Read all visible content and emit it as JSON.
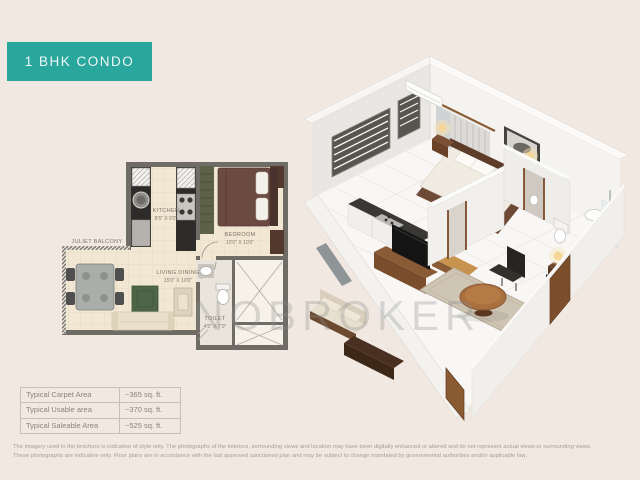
{
  "header": {
    "badge": "1 BHK CONDO"
  },
  "watermark": "NOBROKER",
  "floorplan": {
    "kitchen_name": "KITCHEN",
    "kitchen_dims": "8'6\" X 9'2\"",
    "bedroom_name": "BEDROOM",
    "bedroom_dims": "10'0\" X 10'0\"",
    "living_name": "LIVING DINING",
    "living_dims": "15'0\" X 10'0\"",
    "balcony_name": "JULIET BALCONY",
    "toilet_name": "TOILET",
    "toilet_dims": "4'5\" X 7'0\""
  },
  "area_table": {
    "rows": [
      {
        "label": "Typical Carpet Area",
        "value": "~365 sq. ft."
      },
      {
        "label": "Typical Usable area",
        "value": "~370 sq. ft."
      },
      {
        "label": "Typical Saleable Area",
        "value": "~525 sq. ft."
      }
    ]
  },
  "disclaimer": {
    "line1": "The imagery used in the brochure is indicative of style only. The photographs of the interiors, surrounding views and location may have been digitally enhanced or altered and do not represent actual views or surrounding views.",
    "line2": "These photographs are indicative only. Floor plans are in accordance with the last approved sanctioned plan and may be subject to change mandated by governmental authorities and/or applicable law."
  },
  "colors": {
    "background": "#f1e8e1",
    "badge_teal": "#2aa79d",
    "plan_floor": "#f1e7d3",
    "plan_wall": "#6f6c66",
    "counter_dark": "#2e2c2a",
    "bed_brown": "#6b4a41",
    "rug_green": "#4e6647",
    "table_text": "#8d8378",
    "watermark_gray": "#8d8d8d"
  }
}
